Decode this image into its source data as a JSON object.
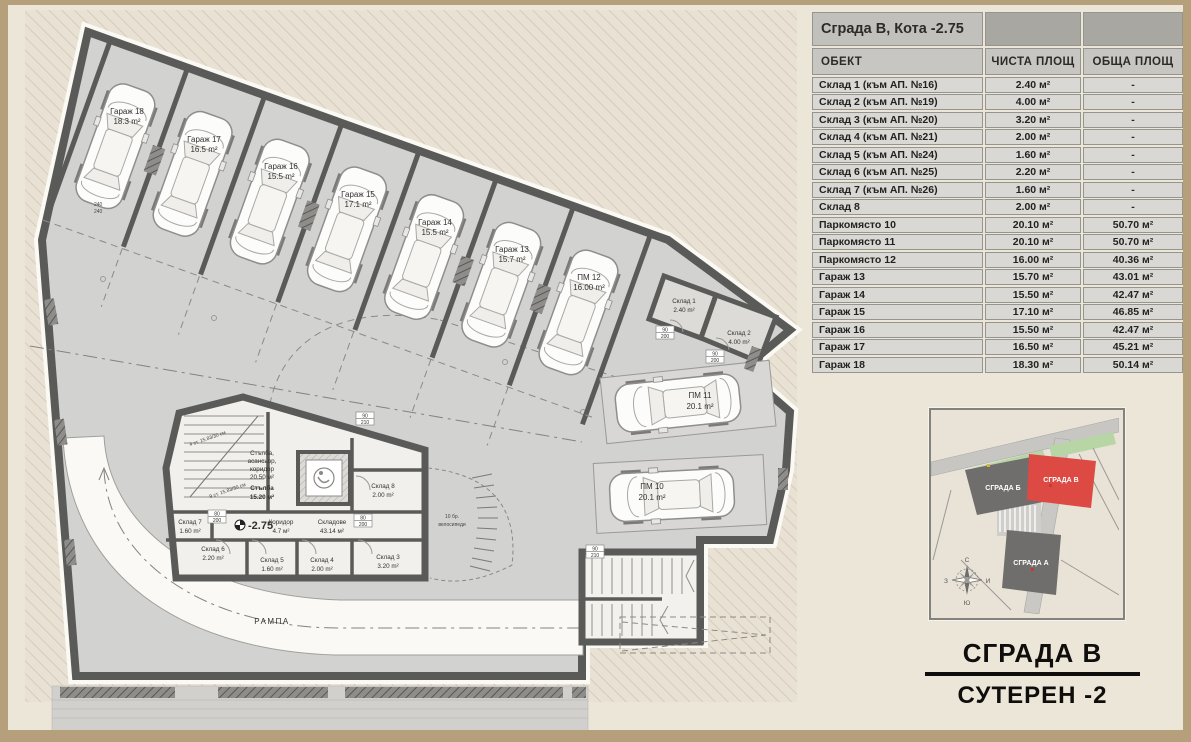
{
  "table": {
    "title": "Сграда В, Кота -2.75",
    "columns": [
      "ОБЕКТ",
      "ЧИСТА ПЛОЩ",
      "ОБЩА ПЛОЩ"
    ],
    "rows": [
      {
        "name": "Склад 1 (към АП. №16)",
        "net": "2.40 м²",
        "gross": "-"
      },
      {
        "name": "Склад 2 (към АП. №19)",
        "net": "4.00 м²",
        "gross": "-"
      },
      {
        "name": "Склад 3 (към АП. №20)",
        "net": "3.20 м²",
        "gross": "-"
      },
      {
        "name": "Склад 4 (към АП. №21)",
        "net": "2.00 м²",
        "gross": "-"
      },
      {
        "name": "Склад 5 (към АП. №24)",
        "net": "1.60 м²",
        "gross": "-"
      },
      {
        "name": "Склад 6 (към АП. №25)",
        "net": "2.20 м²",
        "gross": "-"
      },
      {
        "name": "Склад 7 (към АП. №26)",
        "net": "1.60 м²",
        "gross": "-"
      },
      {
        "name": "Склад 8",
        "net": "2.00 м²",
        "gross": "-"
      },
      {
        "name": "Паркомясто 10",
        "net": "20.10 м²",
        "gross": "50.70 м²"
      },
      {
        "name": "Паркомясто 11",
        "net": "20.10 м²",
        "gross": "50.70 м²"
      },
      {
        "name": "Паркомясто 12",
        "net": "16.00 м²",
        "gross": "40.36 м²"
      },
      {
        "name": "Гараж 13",
        "net": "15.70 м²",
        "gross": "43.01 м²"
      },
      {
        "name": "Гараж 14",
        "net": "15.50 м²",
        "gross": "42.47 м²"
      },
      {
        "name": "Гараж 15",
        "net": "17.10 м²",
        "gross": "46.85 м²"
      },
      {
        "name": "Гараж 16",
        "net": "15.50 м²",
        "gross": "42.47 м²"
      },
      {
        "name": "Гараж 17",
        "net": "16.50 м²",
        "gross": "45.21 м²"
      },
      {
        "name": "Гараж 18",
        "net": "18.30 м²",
        "gross": "50.14 м²"
      }
    ]
  },
  "titleblock": {
    "line1": "СГРАДА В",
    "line2": "СУТЕРЕН -2"
  },
  "siteplan": {
    "building_b": "СГРАДА Б",
    "building_v": "СГРАДА В",
    "building_a": "СГРАДА А",
    "compass": {
      "n": "С",
      "e": "И",
      "s": "Ю",
      "w": "З"
    }
  },
  "plan": {
    "garages": [
      {
        "name": "Гараж 18",
        "area": "18.3 m²"
      },
      {
        "name": "Гараж 17",
        "area": "16.5 m²"
      },
      {
        "name": "Гараж 16",
        "area": "15.5 m²"
      },
      {
        "name": "Гараж 15",
        "area": "17.1 m²"
      },
      {
        "name": "Гараж 14",
        "area": "15.5 m²"
      },
      {
        "name": "Гараж 13",
        "area": "15.7 m²"
      },
      {
        "name": "ПМ 12",
        "area": "16.00 m²"
      }
    ],
    "parking": [
      {
        "name": "ПМ 11",
        "area": "20.1 m²"
      },
      {
        "name": "ПМ 10",
        "area": "20.1 m²"
      }
    ],
    "storage": [
      {
        "name": "Склад 1",
        "area": "2.40 m²"
      },
      {
        "name": "Склад 2",
        "area": "4.00 m²"
      },
      {
        "name": "Склад 3",
        "area": "3.20 m²"
      },
      {
        "name": "Склад 4",
        "area": "2.00 m²"
      },
      {
        "name": "Склад 5",
        "area": "1.60 m²"
      },
      {
        "name": "Склад 6",
        "area": "2.20 m²"
      },
      {
        "name": "Склад 7",
        "area": "1.60 m²"
      },
      {
        "name": "Склад 8",
        "area": "2.00 m²"
      }
    ],
    "core": {
      "lobby1": "Стълба,",
      "lobby2": "асансьор,",
      "lobby3": "коридор",
      "lobby_area": "20.50 м²",
      "stair": "Стълба",
      "stair_area": "15.20 м²",
      "corridor": "Коридор",
      "corridor_area": "4.7 м²",
      "storages": "Складове",
      "storages_area": "43.14 м²",
      "level": "-2.75",
      "bikes1": "10 бр.",
      "bikes2": "велосипеди",
      "note1": "4 ст. 15.83/30 см",
      "note2": "9 ст. 15.83/30 см"
    },
    "ramp": "РАМПА",
    "dims": {
      "d1": "240",
      "d2": "240"
    },
    "door_marks": [
      {
        "w": "80",
        "h": "200"
      },
      {
        "w": "90",
        "h": "210"
      },
      {
        "w": "90",
        "h": "200"
      },
      {
        "w": "90",
        "h": "200"
      },
      {
        "w": "80",
        "h": "200"
      },
      {
        "w": "90",
        "h": "210"
      }
    ]
  }
}
